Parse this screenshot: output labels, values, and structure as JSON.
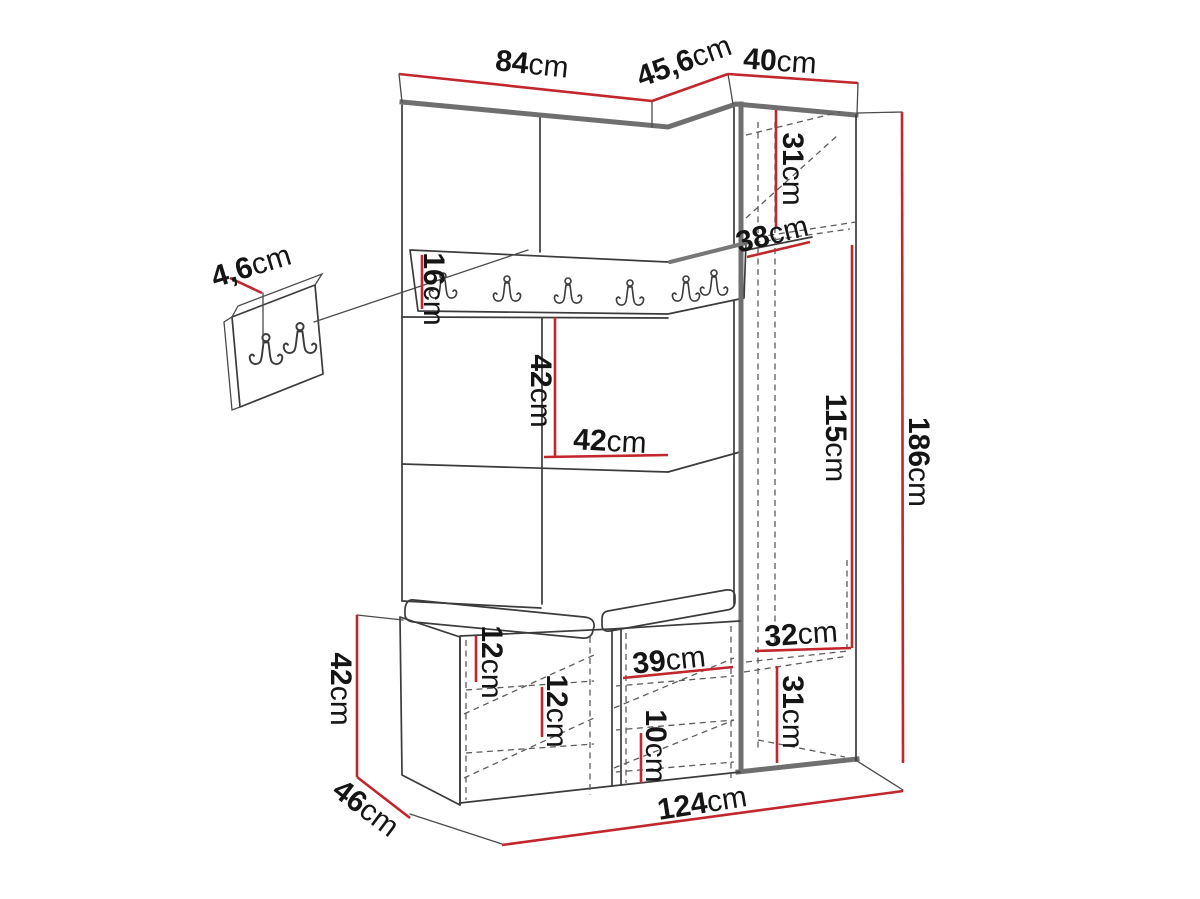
{
  "diagram": {
    "type": "furniture-dimension-drawing",
    "subject": "hallway wardrobe set with coat-hook rail, corner cabinet, bench and wall hook panel",
    "colors": {
      "background": "#ffffff",
      "dimension_red": "#c1272d",
      "outline_dark": "#3b3b3b",
      "edge_gray": "#6f6f6f"
    },
    "icons": {
      "coat_hook": "double-coat-hook-icon"
    },
    "dims": [
      {
        "id": "top-width-left",
        "value": "84",
        "unit": "cm"
      },
      {
        "id": "top-width-corner",
        "value": "45,6",
        "unit": "cm"
      },
      {
        "id": "top-width-wardrobe",
        "value": "40",
        "unit": "cm"
      },
      {
        "id": "wardrobe-top-shelf-h",
        "value": "31",
        "unit": "cm"
      },
      {
        "id": "corner-shelf-depth",
        "value": "38",
        "unit": "cm"
      },
      {
        "id": "hook-rail-height",
        "value": "16",
        "unit": "cm"
      },
      {
        "id": "hook-panel-thickness",
        "value": "4,6",
        "unit": "cm"
      },
      {
        "id": "mid-panel-height",
        "value": "42",
        "unit": "cm"
      },
      {
        "id": "mid-panel-width",
        "value": "42",
        "unit": "cm"
      },
      {
        "id": "hanging-space-height",
        "value": "115",
        "unit": "cm"
      },
      {
        "id": "total-height",
        "value": "186",
        "unit": "cm"
      },
      {
        "id": "bottom-shelf-width",
        "value": "32",
        "unit": "cm"
      },
      {
        "id": "bottom-compartment-h",
        "value": "31",
        "unit": "cm"
      },
      {
        "id": "bench-compartment-w",
        "value": "39",
        "unit": "cm"
      },
      {
        "id": "shoe-shelf-gap",
        "value": "10",
        "unit": "cm"
      },
      {
        "id": "bench-shelf-gap-top",
        "value": "12",
        "unit": "cm"
      },
      {
        "id": "bench-shelf-gap-mid",
        "value": "12",
        "unit": "cm"
      },
      {
        "id": "bench-height",
        "value": "42",
        "unit": "cm"
      },
      {
        "id": "bench-depth",
        "value": "46",
        "unit": "cm"
      },
      {
        "id": "total-width",
        "value": "124",
        "unit": "cm"
      }
    ]
  }
}
